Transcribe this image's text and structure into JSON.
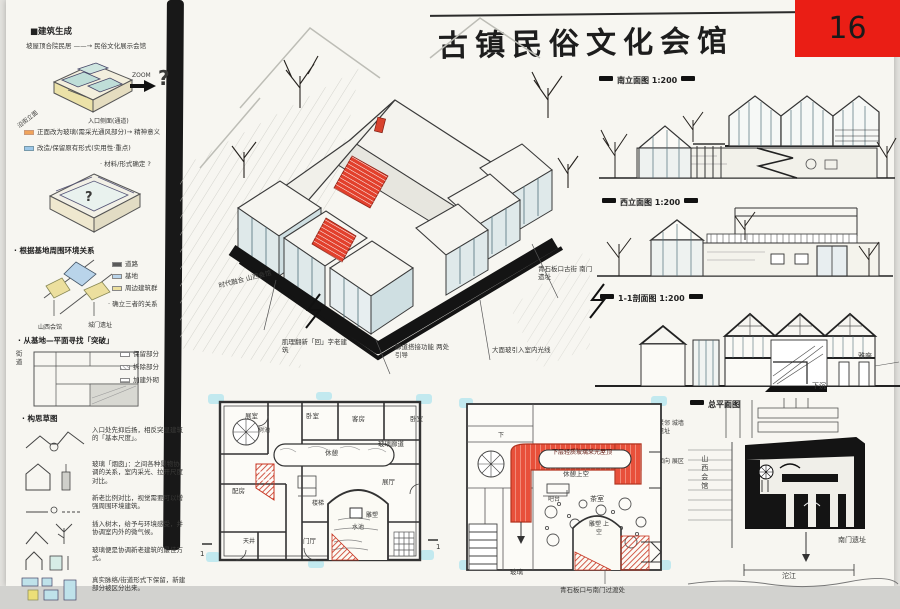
{
  "page": {
    "number": "16"
  },
  "title": {
    "text": "古镇民俗文化会馆"
  },
  "sidebar": {
    "s1_heading": "■建筑生成",
    "s1_line": "坡屋顶合院民居 ——→ 民俗文化展示会馆",
    "zoom_label": "ZOOM",
    "question1": "?",
    "cap_left": "沿街立面",
    "cap_right": "入口侧面(通道)",
    "note_orange": "正面改为玻璃(需采光通风部分)→ 精神意义",
    "note_blue": "改造/保留原有形式(实用性·重点)",
    "note_material": "· 材料/形式确定 ?",
    "question2": "?",
    "s2_heading": "· 根据基地周围环境关系",
    "legend2": [
      {
        "label": "道路"
      },
      {
        "label": "基地"
      },
      {
        "label": "周边建筑群"
      }
    ],
    "site_label_left": "山西会馆",
    "site_label_right": "城门遗址",
    "s2_note": "· 确立三者的关系",
    "s3_heading": "· 从基地—平面寻找「突破」",
    "legend3": [
      {
        "label": "保留部分"
      },
      {
        "label": "拆除部分"
      },
      {
        "label": "加建外砌"
      }
    ],
    "s3_side": "街道",
    "s4_heading": "· 构思草图",
    "sketch_notes": [
      {
        "text": "入口处先抑后扬，相反突显建筑的「基本尺度」。"
      },
      {
        "text": "玻璃「烟囱」：之间各种景物协调的关系，室内采光、拉开尺度对比。"
      },
      {
        "text": "新老比例对比，视觉需要可以增强周围环境建筑。"
      },
      {
        "text": "插入树木，给予与环境感受，并协调室内外的微气候。"
      },
      {
        "text": "玻璃便是协调新老建筑的最佳方式。"
      },
      {
        "text": "真实脉络/街道形式下保留，新建部分被区分出来。"
      }
    ]
  },
  "center": {
    "label_era": "时代融合 山西会馆",
    "label_texture": "肌理翻新「回」字老建筑",
    "label_corridor": "廊道搭接功能 两处引导",
    "label_glass": "大面玻引入室内光线",
    "label_street": "青石板口古街 南门遗址"
  },
  "right": {
    "south_title": "南立面图 1:200",
    "west_title": "西立面图 1:200",
    "section_title": "1-1剖面图 1:200",
    "section_label_seat": "雅座",
    "section_label_sunken": "下沉",
    "siteplan_title": "总平面图",
    "siteplan_hall": "山西会馆",
    "siteplan_gate": "南门遗址",
    "siteplan_river": "沱江",
    "note_wall": "紧邻 城墙 遗址",
    "note_zone": "面向 展区"
  },
  "plans": {
    "first": {
      "room_exhibit": "展室",
      "room_bed1": "卧室",
      "room_guest": "客房",
      "room_bed2": "卧室",
      "tree_pool": "树池",
      "glass_corridor": "玻璃廊道",
      "rest": "休憩",
      "stair": "楼梯",
      "side_room": "配房",
      "hall": "展厅",
      "court": "天井",
      "entry_hall": "门厅",
      "sculpture": "雕塑",
      "pool": "水池",
      "mark_left": "1",
      "mark_right": "1"
    },
    "second": {
      "down": "下",
      "red_band": "下层轻质玻璃采光屋顶",
      "rest_void": "休憩上空",
      "bar": "吧台",
      "tea_room": "茶室",
      "sculpture_void": "雕塑 上空",
      "glass": "玻璃",
      "street_note": "青石板口与南门过渡处"
    }
  }
}
